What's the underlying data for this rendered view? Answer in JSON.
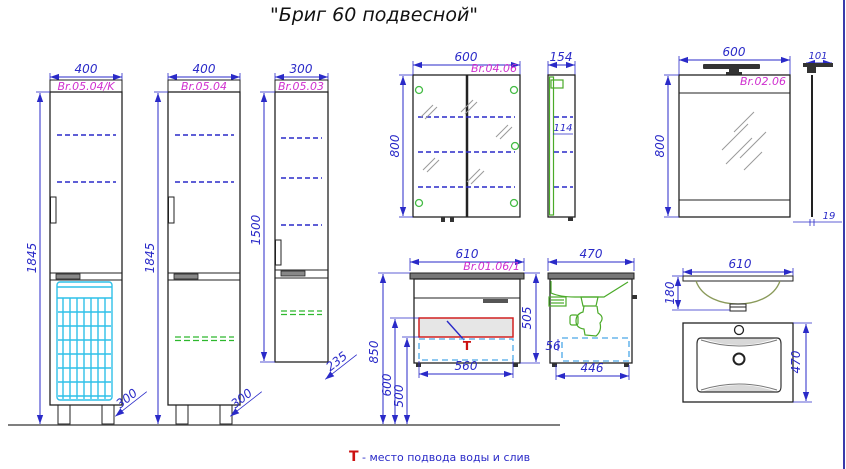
{
  "title": "\"Бриг 60 подвесной\"",
  "note": {
    "symbol": "Т",
    "text": "- место подвода воды и слив"
  },
  "colors": {
    "dimension_blue": "#2a2ac8",
    "label_magenta": "#cf2fcf",
    "basket_cyan": "#2fc0e8",
    "shelf_green": "#2db82d",
    "supply_red": "#cc1111",
    "sink_green": "#4aaa28"
  },
  "items": {
    "cab_k": {
      "code": "Br.05.04/K",
      "width": "400",
      "height": "1845",
      "depth": "300"
    },
    "cab": {
      "code": "Br.05.04",
      "width": "400",
      "height": "1845",
      "depth": "300"
    },
    "wall_cab": {
      "code": "Br.05.03",
      "width": "300",
      "height": "1500",
      "depth": "235"
    },
    "mir_cab": {
      "code": "Br.04.06",
      "width": "600",
      "height": "800",
      "depth": "154",
      "shelf_dim": "114"
    },
    "mirror": {
      "code": "Br.02.06",
      "width": "600",
      "height": "800",
      "lamp_depth": "101",
      "glass_thickness": "19"
    },
    "vanity": {
      "code": "Br.01.06/1",
      "width": "610",
      "front_height": "505",
      "drawer_width": "560",
      "mount_height": "850",
      "supply_height": "600",
      "drain_height": "500",
      "depth": "470",
      "inner_width": "446",
      "gap": "56",
      "t_mark": "Т"
    },
    "sink": {
      "width": "610",
      "bowl_depth": "180",
      "depth": "470"
    }
  }
}
